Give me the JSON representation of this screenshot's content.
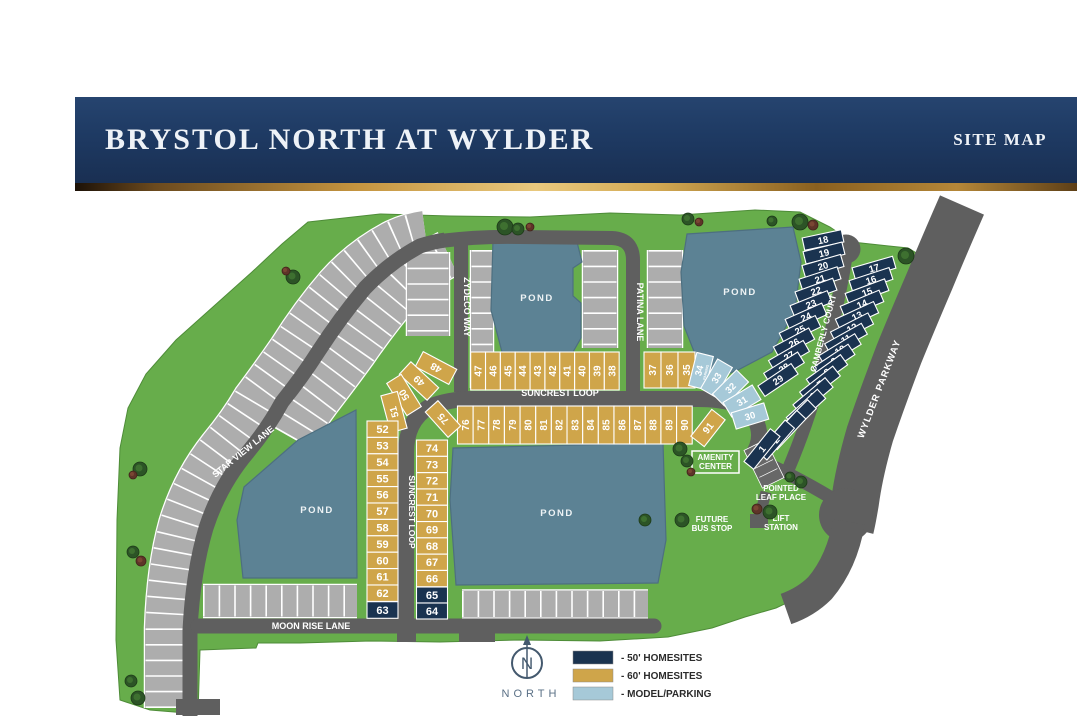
{
  "header": {
    "title": "BRYSTOL NORTH AT WYLDER",
    "right": "SITE MAP"
  },
  "colors": {
    "navy": "#1a3350",
    "gold": "#cfa54a",
    "model": "#a6c9d8",
    "green": "#67ad4b",
    "pond": "#5c8294",
    "road": "#5f5f5f",
    "gray_lot": "#adadad",
    "header_navy": "#1e3a63"
  },
  "streets": {
    "star_view": "STAR VIEW LANE",
    "zydeco": "ZYDECO WAY",
    "patina": "PATINA LANE",
    "suncrest": "SUNCREST LOOP",
    "moon_rise": "MOON RISE LANE",
    "camberly": "CAMBERLY COURT",
    "wylder": "WYLDER PARKWAY"
  },
  "landmarks": {
    "pond": "POND",
    "amenity": [
      "AMENITY",
      "CENTER"
    ],
    "bus": [
      "FUTURE",
      "BUS STOP"
    ],
    "lift": [
      "LIFT",
      "STATION"
    ],
    "pointed_leaf": [
      "POINTED",
      "LEAF PLACE"
    ],
    "parking_sub": "PARKING"
  },
  "legend": {
    "north": "NORTH",
    "north_letter": "N",
    "items": [
      {
        "label": "- 50' HOMESITES",
        "color": "#1a3350"
      },
      {
        "label": "- 60' HOMESITES",
        "color": "#cfa54a"
      },
      {
        "label": "- MODEL/PARKING",
        "color": "#a6c9d8"
      }
    ]
  },
  "lots": {
    "suncrest_north": [
      47,
      46,
      45,
      44,
      43,
      42,
      41,
      40,
      39,
      38
    ],
    "patina_east": [
      37,
      36,
      35
    ],
    "model_arc": [
      34,
      33,
      32,
      31,
      30
    ],
    "suncrest_south": [
      76,
      77,
      78,
      79,
      80,
      81,
      82,
      83,
      84,
      85,
      86,
      87,
      88,
      89,
      90
    ],
    "lot91": 91,
    "lot75": 75,
    "curve_sw_outer": [
      48,
      49,
      50,
      51
    ],
    "west_outer": [
      52,
      53,
      54,
      55,
      56,
      57,
      58,
      59,
      60,
      61,
      62
    ],
    "west_outer_navy": [
      63
    ],
    "west_inner": [
      74,
      73,
      72,
      71,
      70,
      69,
      68,
      67,
      66
    ],
    "west_inner_navy": [
      65,
      64
    ],
    "camberly_west": [
      18,
      19,
      20,
      21,
      22,
      23,
      24,
      25,
      26,
      27,
      28,
      29
    ],
    "camberly_east": [
      17,
      16,
      15,
      14,
      13,
      12,
      11,
      10,
      9,
      8,
      7,
      6,
      5,
      4,
      3,
      2,
      1
    ]
  }
}
